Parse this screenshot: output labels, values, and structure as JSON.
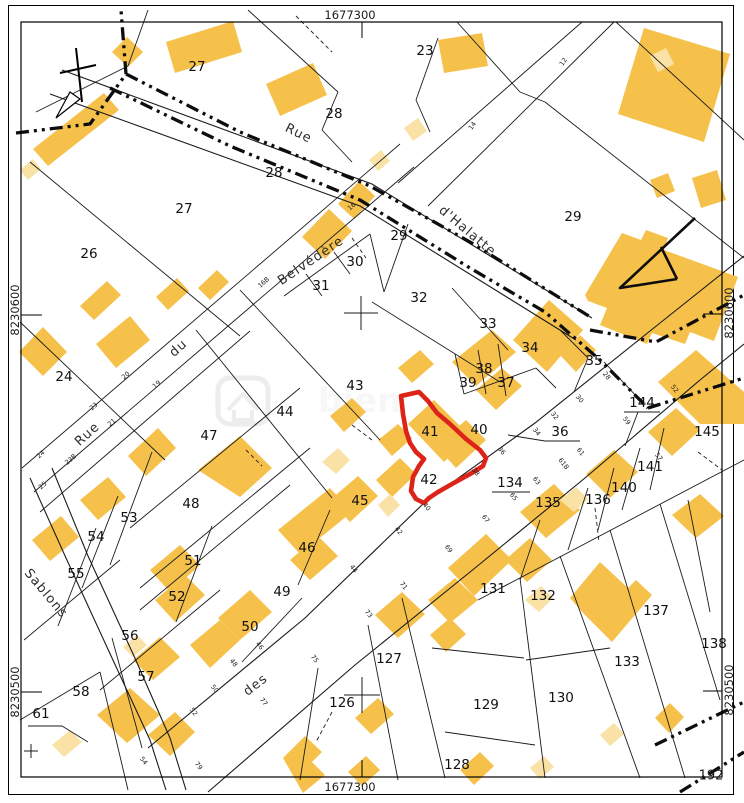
{
  "map": {
    "frame": {
      "top": "1677300",
      "bottom": "1677300",
      "left_upper": "8230600",
      "left_lower": "8230500",
      "right_upper": "8230600",
      "right_lower": "8230500",
      "corner": "192"
    },
    "colors": {
      "building": "#F6C14B",
      "building_light": "#FAE2A6",
      "line": "#1b1b1b",
      "red": "#DD2418",
      "watermark": "#ededed"
    },
    "streets": [
      {
        "label": "Rue",
        "x": 90,
        "y": 437,
        "rot": -42
      },
      {
        "label": "du",
        "x": 181,
        "y": 351,
        "rot": -42
      },
      {
        "label": "Belvédère",
        "x": 313,
        "y": 264,
        "rot": -34
      },
      {
        "label": "Rue",
        "x": 297,
        "y": 137,
        "rot": 26
      },
      {
        "label": "d'Halatte",
        "x": 465,
        "y": 234,
        "rot": 40
      },
      {
        "label": "des",
        "x": 258,
        "y": 688,
        "rot": -38
      },
      {
        "label": "Sablons",
        "x": 43,
        "y": 596,
        "rot": 50
      }
    ],
    "parcels": [
      {
        "n": "27",
        "x": 197,
        "y": 67
      },
      {
        "n": "23",
        "x": 425,
        "y": 51
      },
      {
        "n": "28",
        "x": 334,
        "y": 114
      },
      {
        "n": "28",
        "x": 274,
        "y": 173
      },
      {
        "n": "27",
        "x": 184,
        "y": 209
      },
      {
        "n": "29",
        "x": 573,
        "y": 217
      },
      {
        "n": "26",
        "x": 89,
        "y": 254
      },
      {
        "n": "29",
        "x": 399,
        "y": 236
      },
      {
        "n": "30",
        "x": 355,
        "y": 262
      },
      {
        "n": "31",
        "x": 321,
        "y": 286
      },
      {
        "n": "32",
        "x": 419,
        "y": 298
      },
      {
        "n": "33",
        "x": 488,
        "y": 324
      },
      {
        "n": "34",
        "x": 530,
        "y": 348
      },
      {
        "n": "24",
        "x": 64,
        "y": 377
      },
      {
        "n": "35",
        "x": 594,
        "y": 361
      },
      {
        "n": "38",
        "x": 484,
        "y": 369
      },
      {
        "n": "39",
        "x": 468,
        "y": 383
      },
      {
        "n": "37",
        "x": 506,
        "y": 383
      },
      {
        "n": "43",
        "x": 355,
        "y": 386
      },
      {
        "n": "144",
        "x": 642,
        "y": 403
      },
      {
        "n": "44",
        "x": 285,
        "y": 412
      },
      {
        "n": "47",
        "x": 209,
        "y": 436
      },
      {
        "n": "41",
        "x": 430,
        "y": 432
      },
      {
        "n": "40",
        "x": 479,
        "y": 430
      },
      {
        "n": "36",
        "x": 560,
        "y": 432
      },
      {
        "n": "145",
        "x": 707,
        "y": 432
      },
      {
        "n": "42",
        "x": 429,
        "y": 480
      },
      {
        "n": "134",
        "x": 510,
        "y": 483
      },
      {
        "n": "141",
        "x": 650,
        "y": 467
      },
      {
        "n": "140",
        "x": 624,
        "y": 488
      },
      {
        "n": "136",
        "x": 598,
        "y": 500
      },
      {
        "n": "135",
        "x": 548,
        "y": 503
      },
      {
        "n": "45",
        "x": 360,
        "y": 501
      },
      {
        "n": "48",
        "x": 191,
        "y": 504
      },
      {
        "n": "53",
        "x": 129,
        "y": 518
      },
      {
        "n": "54",
        "x": 96,
        "y": 537
      },
      {
        "n": "46",
        "x": 307,
        "y": 548
      },
      {
        "n": "51",
        "x": 193,
        "y": 561
      },
      {
        "n": "55",
        "x": 76,
        "y": 574
      },
      {
        "n": "49",
        "x": 282,
        "y": 592
      },
      {
        "n": "52",
        "x": 177,
        "y": 597
      },
      {
        "n": "50",
        "x": 250,
        "y": 627
      },
      {
        "n": "56",
        "x": 130,
        "y": 636
      },
      {
        "n": "57",
        "x": 146,
        "y": 677
      },
      {
        "n": "58",
        "x": 81,
        "y": 692
      },
      {
        "n": "61",
        "x": 41,
        "y": 714
      },
      {
        "n": "126",
        "x": 342,
        "y": 703
      },
      {
        "n": "127",
        "x": 389,
        "y": 659
      },
      {
        "n": "131",
        "x": 493,
        "y": 589
      },
      {
        "n": "132",
        "x": 543,
        "y": 596
      },
      {
        "n": "137",
        "x": 656,
        "y": 611
      },
      {
        "n": "133",
        "x": 627,
        "y": 662
      },
      {
        "n": "138",
        "x": 714,
        "y": 644
      },
      {
        "n": "130",
        "x": 561,
        "y": 698
      },
      {
        "n": "129",
        "x": 486,
        "y": 705
      },
      {
        "n": "128",
        "x": 457,
        "y": 765
      }
    ],
    "house_numbers": [
      {
        "n": "16",
        "x": 353,
        "y": 208,
        "r": -41
      },
      {
        "n": "16B",
        "x": 265,
        "y": 284,
        "r": -41
      },
      {
        "n": "20",
        "x": 127,
        "y": 377,
        "r": -41
      },
      {
        "n": "19",
        "x": 158,
        "y": 386,
        "r": -41
      },
      {
        "n": "23",
        "x": 95,
        "y": 408,
        "r": -41
      },
      {
        "n": "21",
        "x": 113,
        "y": 424,
        "r": -41
      },
      {
        "n": "24",
        "x": 42,
        "y": 456,
        "r": -41
      },
      {
        "n": "23B",
        "x": 72,
        "y": 461,
        "r": -41
      },
      {
        "n": "25",
        "x": 44,
        "y": 487,
        "r": -41
      },
      {
        "n": "12",
        "x": 565,
        "y": 63,
        "r": -55
      },
      {
        "n": "14",
        "x": 474,
        "y": 127,
        "r": -55
      },
      {
        "n": "28",
        "x": 605,
        "y": 377,
        "r": 52
      },
      {
        "n": "30",
        "x": 578,
        "y": 400,
        "r": 52
      },
      {
        "n": "32",
        "x": 553,
        "y": 417,
        "r": 52
      },
      {
        "n": "34",
        "x": 535,
        "y": 433,
        "r": 52
      },
      {
        "n": "36",
        "x": 500,
        "y": 452,
        "r": 52
      },
      {
        "n": "38",
        "x": 474,
        "y": 473,
        "r": 52
      },
      {
        "n": "40",
        "x": 425,
        "y": 508,
        "r": 52
      },
      {
        "n": "42",
        "x": 397,
        "y": 532,
        "r": 52
      },
      {
        "n": "44",
        "x": 352,
        "y": 570,
        "r": 52
      },
      {
        "n": "46",
        "x": 258,
        "y": 647,
        "r": 52
      },
      {
        "n": "48",
        "x": 232,
        "y": 664,
        "r": 52
      },
      {
        "n": "50",
        "x": 213,
        "y": 690,
        "r": 52
      },
      {
        "n": "52",
        "x": 192,
        "y": 713,
        "r": 52
      },
      {
        "n": "54",
        "x": 142,
        "y": 762,
        "r": 52
      },
      {
        "n": "57",
        "x": 657,
        "y": 458,
        "r": 52
      },
      {
        "n": "59",
        "x": 625,
        "y": 422,
        "r": 52
      },
      {
        "n": "61",
        "x": 579,
        "y": 453,
        "r": 52
      },
      {
        "n": "61B",
        "x": 562,
        "y": 465,
        "r": 52
      },
      {
        "n": "63",
        "x": 535,
        "y": 482,
        "r": 52
      },
      {
        "n": "65",
        "x": 512,
        "y": 498,
        "r": 52
      },
      {
        "n": "67",
        "x": 484,
        "y": 520,
        "r": 52
      },
      {
        "n": "69",
        "x": 447,
        "y": 550,
        "r": 52
      },
      {
        "n": "71",
        "x": 402,
        "y": 587,
        "r": 52
      },
      {
        "n": "73",
        "x": 367,
        "y": 615,
        "r": 52
      },
      {
        "n": "75",
        "x": 313,
        "y": 660,
        "r": 52
      },
      {
        "n": "77",
        "x": 262,
        "y": 703,
        "r": 52
      },
      {
        "n": "79",
        "x": 197,
        "y": 767,
        "r": 52
      },
      {
        "n": "52",
        "x": 673,
        "y": 390,
        "r": 52
      }
    ],
    "buildings": [
      "112,52 127,37 143,52 128,67",
      "166,42 233,21 242,52 175,73",
      "266,84 313,63 327,95 280,116",
      "33,149 104,93 119,110 48,166",
      "438,40 482,33 488,66 444,73",
      "644,28 730,54 704,142 618,114",
      "692,178 717,170 726,200 701,208",
      "650,180 668,173 675,191 657,198",
      "302,237 329,209 352,231 325,259",
      "338,204 359,181 375,196 354,219",
      "585,295 622,233 641,240 646,230 668,238 664,250 738,277 714,341 690,332 685,344 652,333 647,344 600,325 607,308 588,301",
      "80,306 107,281 121,295 94,320",
      "156,297 177,278 189,291 168,310",
      "198,288 217,270 229,282 210,300",
      "43,327 67,352 43,376 19,352",
      "96,344 130,316 150,340 116,368",
      "128,456 158,428 176,448 146,476",
      "198,470 240,436 272,468 240,497",
      "80,500 108,477 126,497 98,520",
      "32,540 61,516 79,537 50,561",
      "278,530 330,488 352,512 300,554",
      "330,416 352,398 366,412 344,432",
      "408,424 434,400 470,436 444,462",
      "436,446 466,420 486,440 456,468",
      "452,362 492,330 516,352 476,386",
      "476,390 502,368 522,386 496,410",
      "513,340 549,300 583,330 547,372",
      "560,355 580,335 596,350 576,372",
      "398,368 420,350 434,364 412,383",
      "378,440 398,424 412,438 392,456",
      "376,480 400,458 416,474 392,497",
      "658,382 696,350 744,392 744,424 700,424",
      "672,515 700,494 724,516 696,538",
      "448,568 486,534 512,560 474,596",
      "520,512 554,484 580,510 546,538",
      "586,474 614,450 638,472 610,498",
      "648,432 676,408 700,430 672,456",
      "330,500 358,476 378,496 350,522",
      "290,560 318,536 338,556 310,580",
      "218,618 250,590 272,612 240,640",
      "190,645 220,620 240,640 210,668",
      "150,570 180,545 200,565 170,592",
      "155,600 185,575 205,595 175,622",
      "133,660 160,637 180,657 153,680",
      "97,715 130,688 160,715 127,743",
      "148,735 175,712 195,732 170,756",
      "283,758 305,736 322,752 312,762 325,775 303,793",
      "355,718 378,698 394,714 371,734",
      "375,615 402,592 425,614 398,638",
      "428,600 455,578 478,600 450,623",
      "430,635 450,618 466,634 446,652",
      "570,598 600,562 628,588 636,580 652,595 612,642 584,614",
      "655,718 670,703 684,717 669,733",
      "505,560 530,538 552,560 527,582",
      "348,772 366,756 380,770 362,786",
      "460,770 480,752 494,766 474,785"
    ],
    "buildings_light": [
      "20,170 33,159 41,169 28,180",
      "650,56 666,48 674,64 658,72",
      "369,160 381,150 390,161 378,171",
      "404,128 418,118 427,131 413,141",
      "378,505 390,494 400,505 388,517",
      "560,500 576,487 588,499 574,512",
      "525,600 541,586 553,598 539,612",
      "600,735 614,723 624,734 610,746",
      "530,768 544,756 554,767 540,779",
      "123,647 137,635 147,645 133,657",
      "52,745 70,730 82,742 64,757",
      "322,462 338,448 350,460 336,474"
    ],
    "polylines": [
      "148,748 305,618 425,502 535,423 650,331 744,256",
      "208,792 355,665 475,568 585,478 700,380 744,344",
      "30,478 66,558 112,658 150,740 166,790",
      "52,468 88,556 134,656 170,738 186,790",
      "62,70 372,184 592,318",
      "50,94 360,206 576,340"
    ],
    "lines": [
      [
        22,
        468,
        400,
        144
      ],
      [
        34,
        492,
        414,
        167
      ],
      [
        398,
        183,
        582,
        22
      ],
      [
        428,
        206,
        614,
        22
      ],
      [
        545,
        102,
        744,
        258
      ],
      [
        478,
        600,
        744,
        460
      ],
      [
        40,
        512,
        250,
        331
      ],
      [
        128,
        66,
        36,
        112
      ],
      [
        128,
        66,
        148,
        10
      ],
      [
        30,
        162,
        240,
        336
      ],
      [
        248,
        10,
        338,
        92
      ],
      [
        338,
        92,
        322,
        130
      ],
      [
        322,
        130,
        352,
        162
      ],
      [
        457,
        22,
        520,
        92
      ],
      [
        520,
        92,
        545,
        102
      ],
      [
        438,
        38,
        416,
        100
      ],
      [
        416,
        100,
        430,
        132
      ],
      [
        408,
        224,
        384,
        292
      ],
      [
        284,
        296,
        370,
        234
      ],
      [
        306,
        274,
        322,
        296
      ],
      [
        334,
        252,
        350,
        274
      ],
      [
        370,
        234,
        384,
        292
      ],
      [
        372,
        302,
        500,
        382
      ],
      [
        452,
        288,
        508,
        350
      ],
      [
        455,
        354,
        464,
        394
      ],
      [
        478,
        350,
        486,
        394
      ],
      [
        498,
        344,
        506,
        396
      ],
      [
        464,
        394,
        536,
        368
      ],
      [
        536,
        368,
        556,
        388
      ],
      [
        560,
        330,
        588,
        358
      ],
      [
        588,
        358,
        574,
        392
      ],
      [
        604,
        362,
        640,
        400
      ],
      [
        240,
        290,
        380,
        440
      ],
      [
        196,
        330,
        332,
        498
      ],
      [
        130,
        528,
        300,
        388
      ],
      [
        152,
        452,
        110,
        565
      ],
      [
        140,
        588,
        310,
        448
      ],
      [
        118,
        496,
        82,
        588
      ],
      [
        96,
        528,
        58,
        626
      ],
      [
        24,
        640,
        120,
        560
      ],
      [
        140,
        610,
        290,
        485
      ],
      [
        212,
        526,
        176,
        622
      ],
      [
        302,
        598,
        242,
        662
      ],
      [
        100,
        690,
        220,
        590
      ],
      [
        112,
        638,
        142,
        748
      ],
      [
        20,
        720,
        100,
        672
      ],
      [
        100,
        672,
        128,
        790
      ],
      [
        330,
        510,
        298,
        585
      ],
      [
        318,
        668,
        300,
        780
      ],
      [
        368,
        625,
        398,
        780
      ],
      [
        402,
        598,
        445,
        778
      ],
      [
        520,
        578,
        545,
        778
      ],
      [
        560,
        556,
        640,
        778
      ],
      [
        610,
        530,
        685,
        778
      ],
      [
        660,
        504,
        720,
        700
      ],
      [
        432,
        648,
        524,
        658
      ],
      [
        526,
        660,
        610,
        648
      ],
      [
        445,
        732,
        535,
        745
      ],
      [
        540,
        520,
        520,
        580
      ],
      [
        588,
        488,
        568,
        550
      ],
      [
        614,
        468,
        598,
        530
      ],
      [
        640,
        448,
        622,
        510
      ],
      [
        664,
        428,
        650,
        490
      ],
      [
        20,
        322,
        165,
        460
      ],
      [
        616,
        22,
        744,
        140
      ],
      [
        688,
        500,
        710,
        612
      ],
      [
        545,
        441,
        580,
        441
      ],
      [
        508,
        435,
        545,
        441
      ],
      [
        624,
        412,
        660,
        412
      ],
      [
        625,
        446,
        638,
        412
      ],
      [
        492,
        492,
        530,
        492
      ],
      [
        28,
        726,
        62,
        726
      ],
      [
        62,
        726,
        88,
        742
      ]
    ],
    "dashed_lines": [
      [
        296,
        16,
        332,
        52
      ],
      [
        352,
        238,
        366,
        258
      ],
      [
        246,
        450,
        262,
        466
      ],
      [
        595,
        508,
        599,
        542
      ],
      [
        332,
        712,
        316,
        742
      ],
      [
        352,
        425,
        372,
        440
      ],
      [
        698,
        452,
        722,
        470
      ]
    ],
    "bold_boundaries": [
      "16,133 90,124 126,74 121,10",
      "126,74 240,132 370,186 470,242 560,298 592,318",
      "110,88 230,146 360,200 470,268 545,312 600,360 648,408",
      "648,408 744,378",
      "590,330 656,342 744,295",
      "655,745 744,702",
      "680,792 744,752"
    ],
    "red_parcel": "401,396 419,392 428,401 437,413 450,424 466,439 480,450 486,458 483,466 470,474 452,484 438,492 429,498 424,503 416,499 411,491 413,477 419,466 424,459 416,452 410,443 406,431 403,414",
    "ticks": [
      [
        362,
        22,
        362,
        38
      ],
      [
        362,
        760,
        362,
        777
      ],
      [
        21,
        315,
        42,
        315
      ],
      [
        21,
        692,
        42,
        692
      ],
      [
        703,
        314,
        722,
        314
      ],
      [
        703,
        691,
        722,
        691
      ]
    ],
    "crosses": [
      [
        361,
        313,
        17
      ],
      [
        362,
        695,
        18
      ],
      [
        31,
        751,
        7
      ]
    ],
    "north_arrow": {
      "line1": [
        76,
        48,
        82,
        102
      ],
      "line2": [
        60,
        73,
        96,
        65
      ],
      "flag": "70,92 56,118 80,99"
    },
    "church_arrow": "M695,218 L620,288 L677,279 M661,247 L677,279",
    "watermark": {
      "x": 218,
      "y": 378,
      "w": 50,
      "h": 46,
      "glyph": "M228,410 L243,394 L258,410 M234,410 L234,420 L252,420 L252,410",
      "text": "bien",
      "tx": 318,
      "ty": 412
    }
  }
}
